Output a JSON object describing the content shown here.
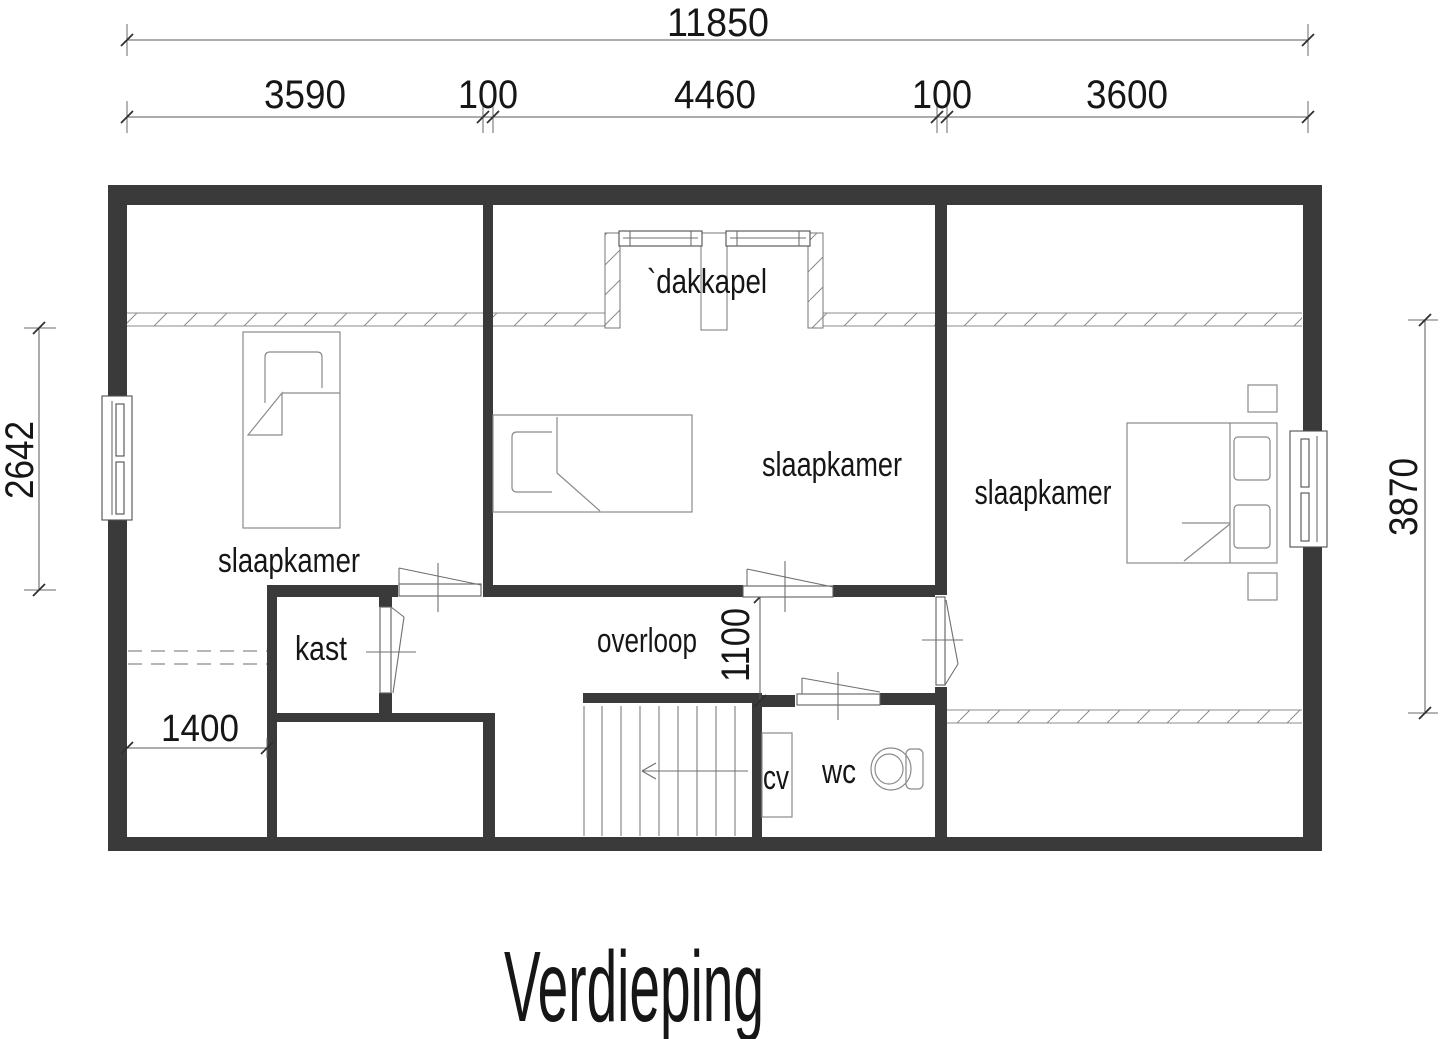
{
  "title": "Verdieping",
  "rooms": {
    "bedroom_left": "slaapkamer",
    "bedroom_middle": "slaapkamer",
    "bedroom_right": "slaapkamer",
    "closet": "kast",
    "landing": "overloop",
    "toilet": "wc",
    "heater": "cv",
    "dormer": "`dakkapel"
  },
  "dimensions": {
    "total_width": "11850",
    "left_width": "3590",
    "wall_left": "100",
    "middle_width": "4460",
    "wall_right": "100",
    "right_width": "3600",
    "left_room_depth": "2642",
    "right_room_depth": "3870",
    "landing_width": "1100",
    "knee_strip_width": "1400"
  },
  "colors": {
    "wall": "#3a3a3a"
  }
}
